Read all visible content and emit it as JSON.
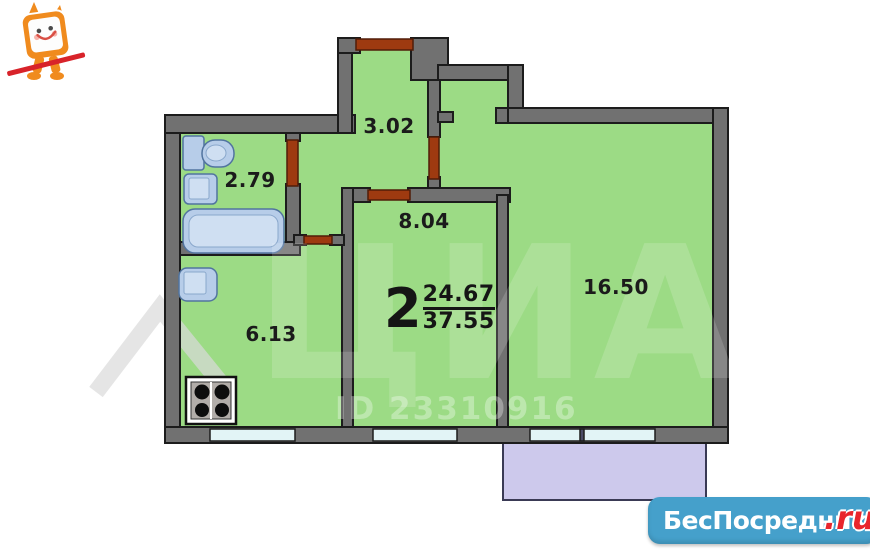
{
  "floor_plan": {
    "summary": {
      "rooms_count": "2",
      "living_area": "24.67",
      "total_area": "37.55"
    },
    "rooms": [
      {
        "name": "hallway",
        "area": "3.02"
      },
      {
        "name": "bathroom",
        "area": "2.79"
      },
      {
        "name": "inner-room",
        "area": "8.04"
      },
      {
        "name": "kitchen",
        "area": "6.13"
      },
      {
        "name": "living-room",
        "area": "16.50"
      }
    ],
    "fixtures": [
      "toilet",
      "sink",
      "bathtub",
      "kitchen-sink",
      "stove-4-burner"
    ],
    "colors": {
      "room_fill": "#9cdb85",
      "wall": "#717171",
      "door": "#9e3a10",
      "window": "#e2f4f6",
      "balcony_fill": "#cdc9ec",
      "fixture_fill": "#b7cde9"
    }
  },
  "watermark": {
    "brand": "ЦИАН",
    "listing_id": "ID 23310916"
  },
  "logo": {
    "site_name": "БесПосредника",
    "domain_suffix": ".ru",
    "bar_color": "#45a0cb",
    "suffix_color": "#e8252c"
  }
}
